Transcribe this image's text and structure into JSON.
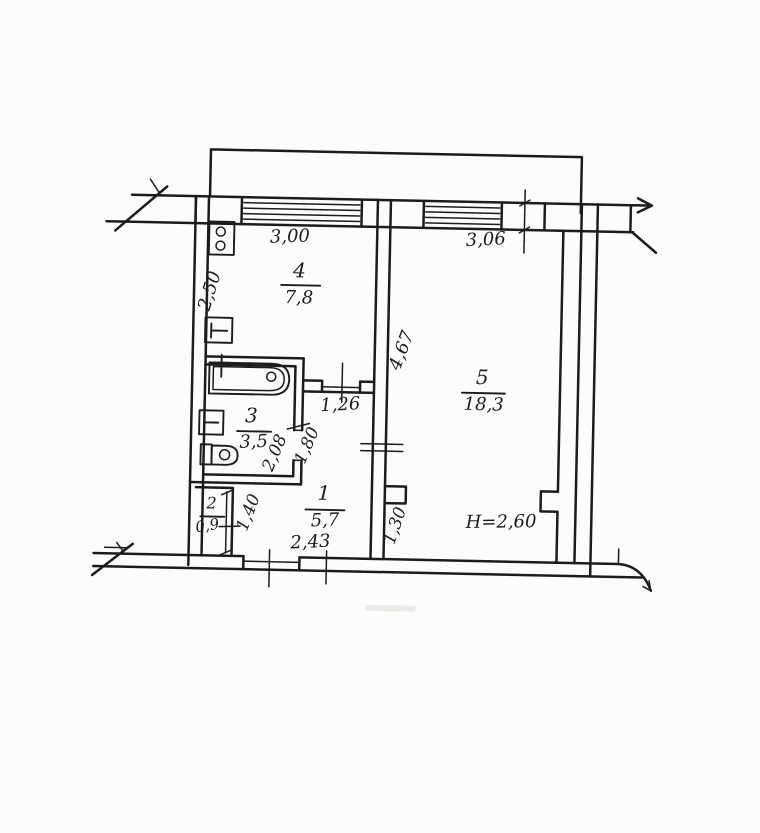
{
  "paper": {
    "background": "#fcfcfa",
    "ink": "#1c1c1c"
  },
  "plan": {
    "rooms": [
      {
        "number": "1",
        "area": "5,7"
      },
      {
        "number": "2",
        "area": "0,9"
      },
      {
        "number": "3",
        "area": "3,5"
      },
      {
        "number": "4",
        "area": "7,8"
      },
      {
        "number": "5",
        "area": "18,3"
      }
    ],
    "dimensions": {
      "window_room4": "3,00",
      "window_room5": "3,06",
      "room4_depth": "2,50",
      "room5_wall_upper": "4,67",
      "corridor_width": "1,26",
      "corridor_depth": "1,80",
      "room3_depth": "2,08",
      "hall_depth": "1,40",
      "hall_width": "2,43",
      "room5_wall_lower": "1,30"
    },
    "ceiling_height": "H=2,60"
  }
}
